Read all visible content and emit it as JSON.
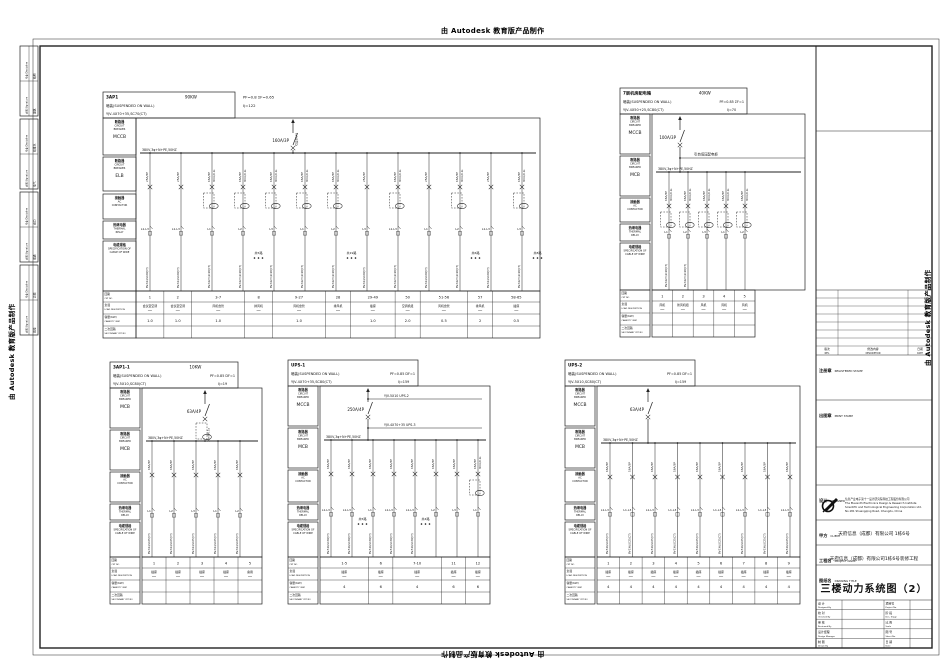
{
  "watermarks": {
    "text": "由 Autodesk 教育版产品制作"
  },
  "sign_strip": {
    "sig_zh": "会签",
    "sig_en": "Signature",
    "disc_zh": "专业",
    "disc_en": "Discipline",
    "blocks": [
      [
        "建筑",
        "结构"
      ],
      [
        "电气",
        "给排水"
      ],
      [
        "暖通",
        "动力"
      ],
      [
        "弱电",
        "总图"
      ]
    ]
  },
  "row_labels": {
    "breaker_zh": "断路器",
    "breaker_en": [
      "CIRCUIT",
      "BREAKER"
    ],
    "contactor_zh": "接触器",
    "contactor_en": [
      "AC",
      "CONTACTOR"
    ],
    "thermal_zh": "热继电器",
    "thermal_en": [
      "THERMAL",
      "RELAY"
    ],
    "spec_zh": "电缆规格",
    "spec_en": [
      "SPECIFICATION OF",
      "CABLE OF WIRE"
    ],
    "ckt_zh": "回路",
    "ckt_en": "CKT NO",
    "load_zh": "负载",
    "load_en": "LOAD DESCRIPTION",
    "cap_zh": "容量(KW)",
    "cap_en": "CAPACITY (KW)",
    "sec_zh": "二次回路",
    "sec_en": "SECONDARY CKT NO"
  },
  "panels": [
    {
      "name": "3AP1",
      "power": "90KW",
      "mount": "暗装(SUSPENDED ON WALL)",
      "cable": "YJV-4X70+35,SC70(CT)",
      "pf": "PF=0.8  ΣF=0.65",
      "ij": "Ij=122",
      "devices": [
        "MCCB",
        "ELB"
      ],
      "feeder_label": "引自3AA1",
      "main_breaker": "160A/3P",
      "bus": "380V,3φ+N+PE,50HZ",
      "branches": [
        {
          "bk": "25A/3P",
          "ph": "L1-L3",
          "cb": "BV-3X4,SC20(CT)"
        },
        {
          "bk": "25A/3P",
          "ph": "L1-L3",
          "cb": "BV-3X4,SC20(CT)"
        },
        {
          "bk": "16A/3P",
          "rcd": "30mA/0.1s",
          "ct": true,
          "ph": "L1",
          "cb": "BV-3X2.5,SC20(CT)"
        },
        {
          "bk": "16A/3P",
          "rcd": "30mA/0.1s",
          "ct": true,
          "ph": "L2",
          "cb": "BV-3X2.5,SC20(CT)",
          "grp": "共5路"
        },
        {
          "bk": "16A/3P",
          "rcd": "30mA/0.1s",
          "ct": true,
          "ph": "L3",
          "cb": "BV-3X2.5,SC20(CT)"
        },
        {
          "bk": "16A/3P",
          "rcd": "30mA/0.1s",
          "ct": true,
          "ph": "L1",
          "cb": "BV-3X2.5,SC20(CT)"
        },
        {
          "bk": "16A/3P",
          "rcd": "30mA/0.1s",
          "ct": true,
          "ph": "L2",
          "cb": "BV-3X2.5,SC20(CT)",
          "grp": "共19路"
        },
        {
          "bk": "25A/3P",
          "ph": "L3",
          "cb": "BV-3X4,SC20(CT)"
        },
        {
          "bk": "16A/3P",
          "rcd": "30mA/0.1s",
          "ct": true,
          "ph": "L1-L3",
          "cb": "BV-3X2.5,SC20(CT)"
        },
        {
          "bk": "25A/3P",
          "ph": "L1",
          "cb": "BV-3X4,SC20(CT)"
        },
        {
          "bk": "16A/3P",
          "rcd": "30mA/0.1s",
          "ct": true,
          "ph": "L2",
          "cb": "BV-3X2.5,SC20(CT)",
          "grp": "共6路"
        },
        {
          "bk": "25A/3P",
          "ph": "L1-L3",
          "cb": "BV-3X4,SC20(CT)"
        },
        {
          "bk": "16A/3P",
          "rcd": "30mA/0.1s",
          "ct": true,
          "ph": "L3",
          "cb": "BV-3X2.5,SC20(CT)",
          "grp": "共8路"
        }
      ],
      "table": {
        "ckts": [
          "1",
          "2",
          "3-7",
          "8",
          "9-27",
          "28",
          "29-49",
          "50",
          "51-56",
          "57",
          "58-65"
        ],
        "loads": [
          "会议室空调",
          "会议室空调",
          "风机盘管",
          "排风机",
          "风机盘管",
          "排风机",
          "插座",
          "空调机组",
          "风机盘管",
          "排风机",
          "插座"
        ],
        "caps": [
          "1.0",
          "1.0",
          "1.0",
          "",
          "1.0",
          "",
          "1.0",
          "2.0",
          "0.5",
          "2",
          "0.5"
        ],
        "w": [
          1,
          1,
          1.9,
          1,
          1.9,
          0.9,
          1.6,
          0.9,
          1.7,
          0.9,
          1.7
        ]
      }
    },
    {
      "name": "7层机房配电箱",
      "power": "40KW",
      "mount": "暗装(SUSPENDED ON WALL)",
      "cable": "YJV-4X50+25,SC80(CT)",
      "pf": "PF=0.85  ΣF=1",
      "ij": "Ij=70",
      "devices": [
        "MCCB",
        "MCB"
      ],
      "note": "引自低压配电柜",
      "main_breaker": "100A/3P",
      "bus": "380V,3φ+N+PE,50HZ",
      "branches": [
        {
          "bk": "16A/3P",
          "rcd": "30mA/0.1s",
          "ct": true,
          "ph": "L1",
          "cb": "BV-3X2.5,SC20(CT)"
        },
        {
          "bk": "16A/3P",
          "rcd": "30mA/0.1s",
          "ct": true,
          "ph": "L2",
          "cb": "BV-3X2.5,SC20(CT)"
        },
        {
          "bk": "16A/3P",
          "rcd": "30mA/0.1s",
          "ct": true,
          "ph": "L3"
        },
        {
          "bk": "16A/3P",
          "rcd": "30mA/0.1s",
          "ct": true,
          "ph": "L1"
        },
        {
          "bk": "16A/3P",
          "rcd": "30mA/0.1s",
          "ct": true,
          "ph": "L2"
        }
      ],
      "table": {
        "ckts": [
          "1",
          "2",
          "3",
          "4",
          "5"
        ],
        "loads": [
          "风机",
          "新风机组",
          "风机",
          "风机",
          "风机"
        ],
        "caps": [
          "",
          "",
          "",
          "",
          ""
        ],
        "w": [
          1,
          1,
          1,
          1,
          1
        ]
      }
    },
    {
      "name": "3AP1-1",
      "power": "10KW",
      "mount": "暗装(SUSPENDED ON WALL)",
      "cable": "YJV-5X10,SC80(CT)",
      "pf": "PF=0.85  DF=1",
      "ij": "Ij=19",
      "devices": [
        "MCB",
        "MCB"
      ],
      "main_breaker": "63A/4P",
      "main_rcd": "30mA/0.1s",
      "main_ct": true,
      "bus": "380V,3φ+N+PE,50HZ",
      "branches": [
        {
          "bk": "16A/3P",
          "ph": "L1",
          "cb": "BV-3X4,SC25(CT)"
        },
        {
          "bk": "16A/3P",
          "ph": "L2",
          "cb": "BV-3X4,SC25(CT)"
        },
        {
          "bk": "16A/3P",
          "ph": "L3",
          "cb": "BV-3X4,SC25(CT)"
        },
        {
          "bk": "16A/3P",
          "ph": "L1",
          "cb": "BV-3X4,SC25(CT)"
        },
        {
          "bk": "16A/3P",
          "ph": "L2",
          "cb": "BV-3X4,SC25(CT)"
        }
      ],
      "table": {
        "ckts": [
          "1",
          "2",
          "3",
          "4",
          "5"
        ],
        "loads": [
          "插座",
          "插座",
          "插座",
          "插座",
          "备用"
        ],
        "caps": [
          "",
          "",
          "",
          "",
          ""
        ],
        "w": [
          1,
          1,
          1,
          1,
          1
        ]
      }
    },
    {
      "name": "UPS-1",
      "power": "",
      "mount": "暗装(SUSPENDED ON WALL)",
      "cable": "YJV-4X70+35,SC80(CT)",
      "pf": "PF=0.85  DF=1",
      "ij": "Ij=159",
      "devices": [
        "MCCB",
        "MCB"
      ],
      "main_breaker": "250A/4P",
      "taps": [
        "YJV-5X10   UPS-2",
        "YJV-4X70+35   UPS-3"
      ],
      "bus": "380V,3φ+N+PE,50HZ",
      "branches": [
        {
          "bk": "16A/3P",
          "ph": "L1-L3",
          "cb": "BV-5X6,SC30(CT)"
        },
        {
          "bk": "16A/3P",
          "ph": "L1-L3",
          "cb": "BV-5X6,SC30(CT)",
          "grp": "共5路"
        },
        {
          "bk": "16A/3P",
          "ph": "L1",
          "cb": "BV-5X6,SC30(CT)"
        },
        {
          "bk": "16A/3P",
          "ph": "L1-L3",
          "cb": "BV-5X6,SC30(CT)"
        },
        {
          "bk": "16A/3P",
          "ph": "L1-L3",
          "cb": "BV-5X6,SC30(CT)",
          "grp": "共4路"
        },
        {
          "bk": "16A/3P",
          "ph": "L2"
        },
        {
          "bk": "16A/3P",
          "ph": "L3"
        },
        {
          "bk": "16A/3P",
          "rcd": "30mA/0.1s",
          "ct": true,
          "ph": "L1"
        }
      ],
      "table": {
        "ckts": [
          "1-5",
          "6",
          "7-10",
          "11",
          "12"
        ],
        "loads": [
          "插座",
          "插座",
          "插座",
          "插座",
          "插座"
        ],
        "caps": [
          "4",
          "6",
          "4",
          "6",
          "6"
        ],
        "w": [
          2,
          1,
          2,
          1,
          1
        ]
      }
    },
    {
      "name": "UPS-2",
      "power": "",
      "mount": "暗装(SUSPENDED ON WALL)",
      "cable": "YJV-5X10,SC80(CT)",
      "pf": "PF=0.85  DF=1",
      "ij": "Ij=159",
      "devices": [
        "MCCB",
        "MCB"
      ],
      "main_breaker": "63A/4P",
      "bus": "380V,3φ+N+PE,50HZ",
      "branches": [
        {
          "bk": "16A/3P",
          "ph": "L1-L3",
          "cb": "BV-5X6,SC25(CT)"
        },
        {
          "bk": "16A/3P",
          "ph": "L1-L3",
          "cb": "BV-5X6,SC25(CT)"
        },
        {
          "bk": "16A/3P",
          "ph": "L1-L3",
          "cb": "BV-5X6,SC25(CT)"
        },
        {
          "bk": "16A/3P",
          "ph": "L1-L3",
          "cb": "BV-5X6,SC25(CT)"
        },
        {
          "bk": "16A/3P",
          "ph": "L1-L3",
          "cb": "BV-5X6,SC25(CT)"
        },
        {
          "bk": "16A/3P",
          "ph": "L1-L3",
          "cb": "BV-5X6,SC25(CT)"
        },
        {
          "bk": "16A/3P",
          "ph": "L1-L3",
          "cb": "BV-5X6,SC25(CT)"
        },
        {
          "bk": "16A/3P",
          "ph": "L1-L3",
          "cb": "BV-5X6,SC25(CT)"
        },
        {
          "bk": "16A/3P",
          "ph": "L1-L3",
          "cb": "BV-5X6,SC25(CT)"
        }
      ],
      "table": {
        "ckts": [
          "1",
          "2",
          "3",
          "4",
          "5",
          "6",
          "7",
          "8",
          "9"
        ],
        "loads": [
          "插座",
          "插座",
          "插座",
          "插座",
          "插座",
          "插座",
          "插座",
          "插座",
          "插座"
        ],
        "caps": [
          "4",
          "4",
          "4",
          "4",
          "4",
          "4",
          "4",
          "4",
          "4"
        ],
        "w": [
          1,
          1,
          1,
          1,
          1,
          1,
          1,
          1,
          1
        ]
      }
    }
  ],
  "title_block": {
    "registered": {
      "zh": "注册章",
      "en": "REGISTERED STAMP"
    },
    "print": {
      "zh": "出图章",
      "en": "PRINT STAMP"
    },
    "designer": {
      "zh": "设计",
      "en": "DESIGNER",
      "l1": "信息产业电子第十一设计研究院科技工程股份有限公司",
      "l2": "The Eleventh Electronics Design & Research Institute",
      "l3": "Scientific and Technological Engineering Corporation Ltd.",
      "l4": "No.181 Shuangqing Road, Chengdu, China"
    },
    "client": {
      "zh": "甲方",
      "en": "CLIENT",
      "value": "天府信息（成都）有限公司 1栋6号"
    },
    "project": {
      "zh": "工程名",
      "en": "PROJECT NAME",
      "value": "天府信息（成都）有限公司1栋6号装修工程"
    },
    "drawing": {
      "zh": "图纸名",
      "en": "DRAWING TITLE",
      "value": "三楼动力系统图（2）"
    },
    "rev_header": {
      "rev_zh": "版次",
      "rev_en": "REV.",
      "desc_zh": "修改内容",
      "desc_en": "DESCRIPTION",
      "date_zh": "日期",
      "date_en": "DATE"
    },
    "grid": {
      "left": [
        [
          "设 计",
          "Designed By"
        ],
        [
          "校 对",
          "Checked By"
        ],
        [
          "审 核",
          "Reviewed By"
        ],
        [
          "设计经理",
          "Design Manager"
        ],
        [
          "制 图",
          "Drawn By"
        ]
      ],
      "right": [
        [
          "项目号",
          "Project No."
        ],
        [
          "阶 段",
          "Des. Stage"
        ],
        [
          "比 例",
          "Scale"
        ],
        [
          "图 号",
          "Sheet No."
        ],
        [
          "日 期",
          "Date"
        ]
      ]
    }
  }
}
